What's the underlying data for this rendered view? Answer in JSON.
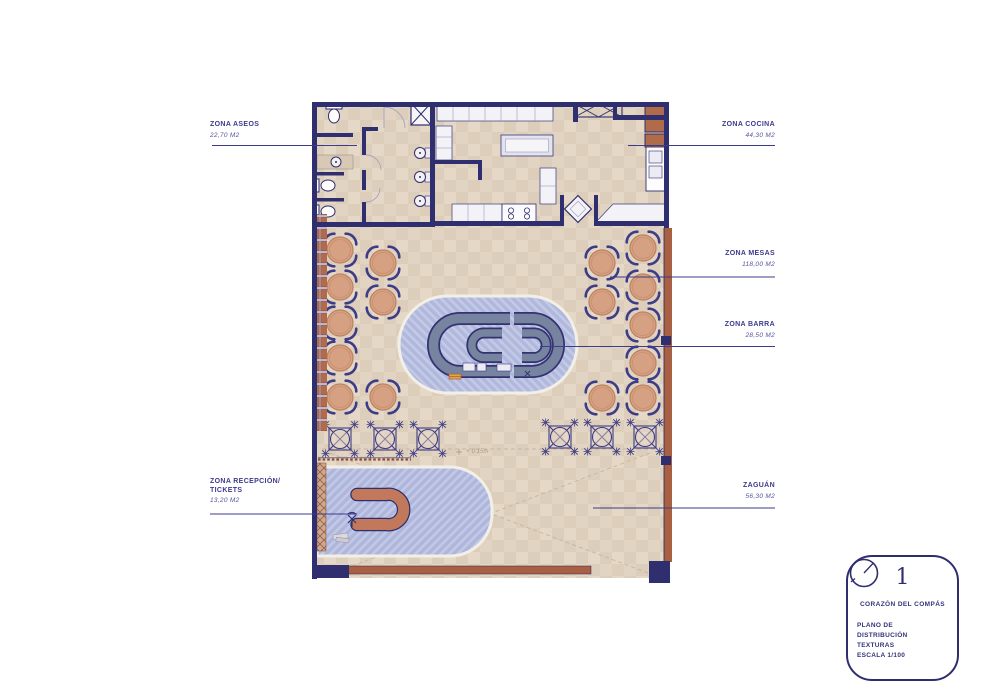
{
  "annotations": {
    "aseos": {
      "title": "ZONA ASEOS",
      "area": "22,70 M2"
    },
    "cocina": {
      "title": "ZONA COCINA",
      "area": "44,30 M2"
    },
    "mesas": {
      "title": "ZONA MESAS",
      "area": "118,00 M2"
    },
    "barra": {
      "title": "ZONA BARRA",
      "area": "28,50 M2"
    },
    "recepcion": {
      "title_line1": "ZONA RECEPCIÓN/",
      "title_line2": "TICKETS",
      "area": "13,20 M2"
    },
    "zaguan": {
      "title": "ZAGUÁN",
      "area": "56,30 M2"
    }
  },
  "plan": {
    "level_marker": "+ 0'15m",
    "furniture": {
      "round_tables": [
        {
          "x": 340,
          "y": 250
        },
        {
          "x": 340,
          "y": 287
        },
        {
          "x": 340,
          "y": 323
        },
        {
          "x": 340,
          "y": 358
        },
        {
          "x": 340,
          "y": 397
        },
        {
          "x": 383,
          "y": 263
        },
        {
          "x": 383,
          "y": 302
        },
        {
          "x": 383,
          "y": 397
        },
        {
          "x": 602,
          "y": 263
        },
        {
          "x": 602,
          "y": 302
        },
        {
          "x": 602,
          "y": 398
        },
        {
          "x": 643,
          "y": 248
        },
        {
          "x": 643,
          "y": 287
        },
        {
          "x": 643,
          "y": 325
        },
        {
          "x": 643,
          "y": 363
        },
        {
          "x": 643,
          "y": 398
        }
      ],
      "x_tables": [
        {
          "x": 340,
          "y": 439
        },
        {
          "x": 385,
          "y": 439
        },
        {
          "x": 428,
          "y": 439
        },
        {
          "x": 560,
          "y": 437
        },
        {
          "x": 602,
          "y": 437
        },
        {
          "x": 645,
          "y": 437
        }
      ]
    }
  },
  "title_block": {
    "sheet_number": "1",
    "project_name": "CORAZÓN DEL COMPÁS",
    "drawing_line1": "PLANO DE DISTRIBUCIÓN",
    "drawing_line2": "TEXTURAS",
    "drawing_line3": "ESCALA 1/100"
  },
  "colors": {
    "navy": "#2f2e6e",
    "label_navy": "#3c3b8c",
    "terracotta": "#a95f41",
    "brick": "#b16a4a",
    "floor_beige": "#e2d4c3",
    "floor_blue": "#b0b9dc",
    "bar_counter": "#77849f",
    "table_salmon": "#d6a082"
  }
}
